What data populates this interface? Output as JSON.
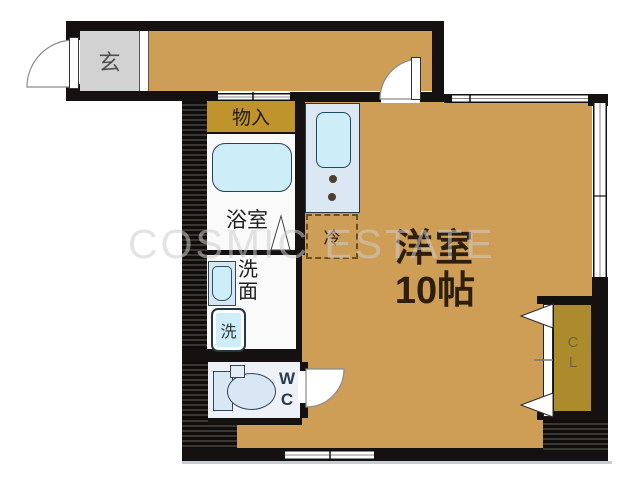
{
  "watermark": {
    "text": "COSMIC ESTATE"
  },
  "rooms": {
    "entrance": {
      "label": "玄"
    },
    "storage": {
      "label": "物入"
    },
    "bathroom": {
      "label": "浴室"
    },
    "washroom": {
      "chars": [
        "洗",
        "面"
      ]
    },
    "washer": {
      "label": "洗"
    },
    "fridge": {
      "label": "冷"
    },
    "wc": {
      "chars": [
        "W",
        "C"
      ]
    },
    "main": {
      "name": "洋室",
      "size": "10帖"
    },
    "closet": {
      "chars": [
        "C",
        "L"
      ]
    }
  },
  "symbols": [
    "entrance-door-swing",
    "interior-door-swing",
    "wc-door-swing",
    "bathroom-door-triangle",
    "folding-closet-door",
    "bathtub",
    "kitchen-sink",
    "gas-burners",
    "washroom-sink",
    "washing-machine",
    "toilet",
    "window",
    "sliding-opening"
  ],
  "colors": {
    "floor": "#ce9e57",
    "gold": "#c0942c",
    "closet-gold": "#ac8b2d",
    "wall": "#141110",
    "kitchen-fill": "#dbe7f2",
    "fixture-cyan": "#cdeef8",
    "wc-fill": "#eef2f8",
    "entrance-gray": "#d2d2d2",
    "room-text": "#2e1f0c"
  }
}
